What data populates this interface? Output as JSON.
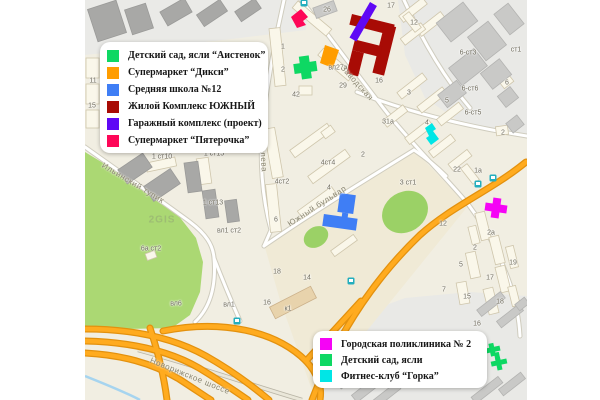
{
  "map": {
    "marker_colors": {
      "aistenok": "#0ed863",
      "diksi": "#ff9d00",
      "school": "#3f7ef5",
      "yuzhny": "#a80b05",
      "garage": "#5f08f5",
      "pyaterochka": "#fe0758",
      "poliklinika": "#f504f5",
      "sad2": "#0ed863",
      "gorka": "#00e6e6"
    },
    "bus_stop_color": "#23aebe",
    "watermark": "2GIS",
    "street_labels": [
      {
        "text": "Заводская",
        "x": 357,
        "y": 83,
        "rot": 48
      },
      {
        "text": "Королева",
        "x": 263,
        "y": 152,
        "rot": 86
      },
      {
        "text": "Южный бульвар",
        "x": 317,
        "y": 206,
        "rot": -33
      },
      {
        "text": "Ильинский тупик",
        "x": 133,
        "y": 183,
        "rot": 31
      },
      {
        "text": "Новорижское шоссе",
        "x": 190,
        "y": 376,
        "rot": 22
      }
    ],
    "building_labels": [
      {
        "text": "11",
        "x": 93,
        "y": 81
      },
      {
        "text": "15",
        "x": 92,
        "y": 106
      },
      {
        "text": "1 ст10",
        "x": 162,
        "y": 157
      },
      {
        "text": "1 ст15",
        "x": 214,
        "y": 154
      },
      {
        "text": "1 ст13",
        "x": 213,
        "y": 203
      },
      {
        "text": "вл1 ст2",
        "x": 229,
        "y": 231
      },
      {
        "text": "6а ст2",
        "x": 151,
        "y": 249
      },
      {
        "text": "вл6",
        "x": 176,
        "y": 304
      },
      {
        "text": "вл1",
        "x": 229,
        "y": 305
      },
      {
        "text": "1",
        "x": 283,
        "y": 47
      },
      {
        "text": "2",
        "x": 283,
        "y": 70
      },
      {
        "text": "42",
        "x": 296,
        "y": 95
      },
      {
        "text": "26",
        "x": 327,
        "y": 10
      },
      {
        "text": "17",
        "x": 391,
        "y": 6
      },
      {
        "text": "12",
        "x": 414,
        "y": 23
      },
      {
        "text": "29",
        "x": 343,
        "y": 86
      },
      {
        "text": "16",
        "x": 379,
        "y": 81
      },
      {
        "text": "вл27а",
        "x": 338,
        "y": 68
      },
      {
        "text": "3",
        "x": 409,
        "y": 93
      },
      {
        "text": "5",
        "x": 447,
        "y": 101
      },
      {
        "text": "31а",
        "x": 388,
        "y": 122
      },
      {
        "text": "4",
        "x": 427,
        "y": 123
      },
      {
        "text": "22",
        "x": 457,
        "y": 170
      },
      {
        "text": "1а",
        "x": 478,
        "y": 171
      },
      {
        "text": "12",
        "x": 443,
        "y": 224
      },
      {
        "text": "2а",
        "x": 491,
        "y": 233
      },
      {
        "text": "2",
        "x": 475,
        "y": 248
      },
      {
        "text": "19",
        "x": 513,
        "y": 263
      },
      {
        "text": "5",
        "x": 461,
        "y": 265
      },
      {
        "text": "17",
        "x": 490,
        "y": 278
      },
      {
        "text": "15",
        "x": 467,
        "y": 297
      },
      {
        "text": "18",
        "x": 500,
        "y": 302
      },
      {
        "text": "7",
        "x": 444,
        "y": 290
      },
      {
        "text": "16",
        "x": 477,
        "y": 324
      },
      {
        "text": "3 ст1",
        "x": 408,
        "y": 183
      },
      {
        "text": "к1",
        "x": 288,
        "y": 309
      },
      {
        "text": "16",
        "x": 267,
        "y": 303
      },
      {
        "text": "14",
        "x": 307,
        "y": 278
      },
      {
        "text": "18",
        "x": 277,
        "y": 272
      },
      {
        "text": "2",
        "x": 363,
        "y": 155
      },
      {
        "text": "4ст4",
        "x": 328,
        "y": 163
      },
      {
        "text": "4ст2",
        "x": 282,
        "y": 182
      },
      {
        "text": "4",
        "x": 329,
        "y": 188
      },
      {
        "text": "6",
        "x": 276,
        "y": 220
      },
      {
        "text": "6-ст3",
        "x": 468,
        "y": 53
      },
      {
        "text": "ст1",
        "x": 516,
        "y": 50
      },
      {
        "text": "6-ст6",
        "x": 470,
        "y": 89
      },
      {
        "text": "6-ст5",
        "x": 473,
        "y": 113
      },
      {
        "text": "6",
        "x": 507,
        "y": 83
      },
      {
        "text": "2",
        "x": 503,
        "y": 133
      }
    ]
  },
  "legends": {
    "top_left": {
      "items": [
        {
          "color": "#0ed863",
          "label": "Детский сад, ясли “Аистенок”"
        },
        {
          "color": "#ff9d00",
          "label": "Супермаркет “Дикси”"
        },
        {
          "color": "#3f7ef5",
          "label": "Средняя школа №12"
        },
        {
          "color": "#a80b05",
          "label": "Жилой Комплекс ЮЖНЫЙ"
        },
        {
          "color": "#5f08f5",
          "label": "Гаражный комплекс (проект)"
        },
        {
          "color": "#fe0758",
          "label": "Супермаркет “Пятерочка”"
        }
      ]
    },
    "bottom_right": {
      "items": [
        {
          "color": "#f504f5",
          "label": "Городская поликлиника № 2"
        },
        {
          "color": "#0ed863",
          "label": "Детский сад, ясли"
        },
        {
          "color": "#00e6e6",
          "label": "Фитнес-клуб “Горка”"
        }
      ]
    }
  }
}
